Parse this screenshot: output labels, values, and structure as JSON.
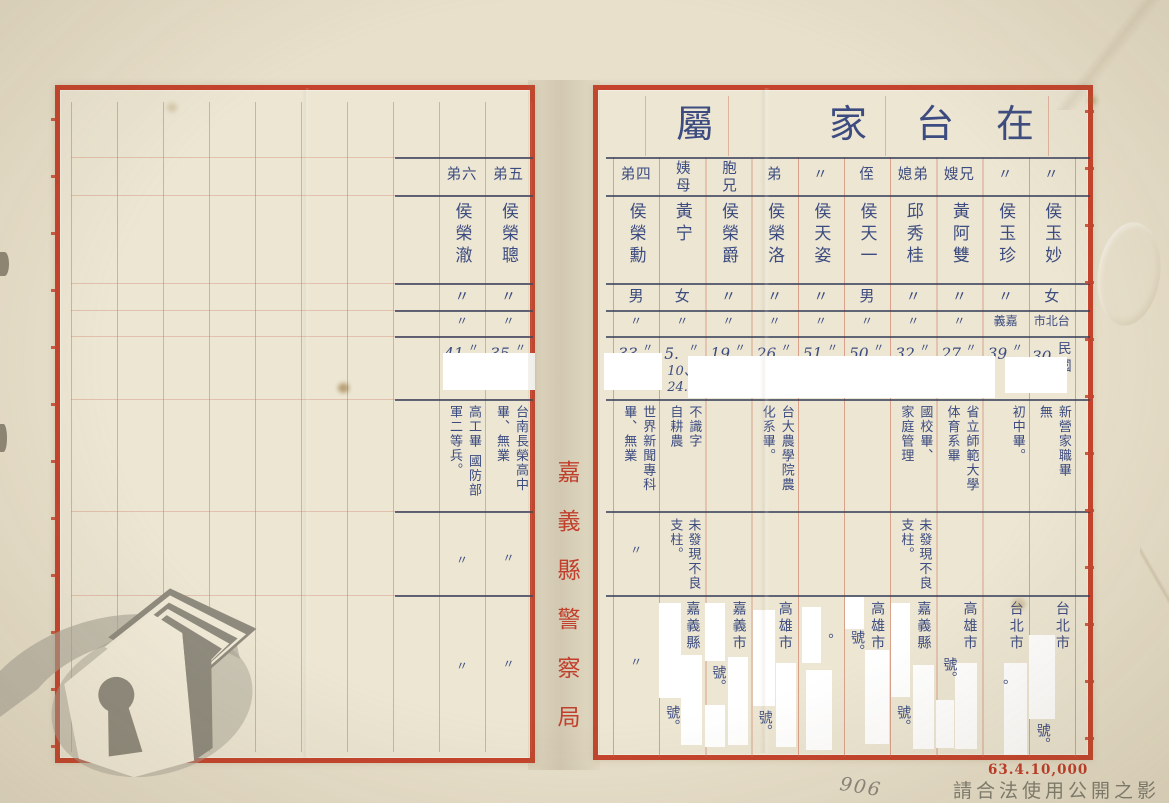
{
  "colors": {
    "paper": "#ece6d3",
    "border_red": "#c5432c",
    "ruling_red": "#ca684e",
    "ink_blue": "#3d4c80",
    "dark_row_line": "#38405c",
    "print_red": "#bf3a26",
    "watermark_gray": "#6c6c60"
  },
  "rp": {
    "header": [
      "屬",
      "家",
      "台",
      "在"
    ],
    "cols": [
      {
        "rel": "弟四",
        "name": "侯榮勳",
        "gender": "男",
        "birthplace": "〃",
        "dit": "〃",
        "num": "33.",
        "extra": "",
        "era": "",
        "edu": "世界新聞專科\n畢、無業",
        "note": "〃",
        "city": "〃",
        "no": ""
      },
      {
        "rel": "姨母",
        "name": "黃宁",
        "gender": "女",
        "birthplace": "〃",
        "dit": "〃",
        "num": "5.",
        "extra": "10、\n24.",
        "era": "",
        "edu": "不識字\n自耕農",
        "note": "未發現不良\n支柱。",
        "city": "嘉義縣",
        "no": "號。"
      },
      {
        "rel": "胞兄",
        "name": "侯榮爵",
        "gender": "〃",
        "birthplace": "〃",
        "dit": "〃",
        "num": "19.",
        "extra": "",
        "era": "",
        "edu": "",
        "note": "",
        "city": "嘉義市",
        "no": "號。"
      },
      {
        "rel": "弟",
        "name": "侯榮洛",
        "gender": "〃",
        "birthplace": "〃",
        "dit": "〃",
        "num": "26.",
        "extra": "",
        "era": "",
        "edu": "台大農學院農\n化系畢。",
        "note": "",
        "city": "高雄市",
        "no": "號。"
      },
      {
        "rel": "〃",
        "name": "侯天姿",
        "gender": "〃",
        "birthplace": "〃",
        "dit": "〃",
        "num": "51.",
        "extra": "",
        "era": "",
        "edu": "",
        "note": "",
        "city": "",
        "no": "。"
      },
      {
        "rel": "侄",
        "name": "侯天一",
        "gender": "男",
        "birthplace": "〃",
        "dit": "〃",
        "num": "50.",
        "extra": "",
        "era": "",
        "edu": "",
        "note": "",
        "city": "高雄市",
        "no": "號。"
      },
      {
        "rel": "媳弟",
        "name": "邱秀桂",
        "gender": "〃",
        "birthplace": "〃",
        "dit": "〃",
        "num": "32.",
        "extra": "",
        "era": "",
        "edu": "國校畢、\n家庭管理",
        "note": "未發現不良\n支柱。",
        "city": "嘉義縣",
        "no": "號。"
      },
      {
        "rel": "嫂兄",
        "name": "黃阿雙",
        "gender": "〃",
        "birthplace": "〃",
        "dit": "〃",
        "num": "27.",
        "extra": "",
        "era": "",
        "edu": "省立師範大學\n体育系畢",
        "note": "",
        "city": "高雄市",
        "no": "號。"
      },
      {
        "rel": "〃",
        "name": "侯玉珍",
        "gender": "〃",
        "birthplace": "義嘉",
        "dit": "〃",
        "num": "39.",
        "extra": "",
        "era": "",
        "edu": "初中畢。",
        "note": "",
        "city": "台北市",
        "no": "。"
      },
      {
        "rel": "〃",
        "name": "侯玉妙",
        "gender": "女",
        "birthplace": "市北台",
        "dit": "",
        "num": "30.",
        "extra": "",
        "era": "民國",
        "edu": "新營家職畢\n無",
        "note": "",
        "city": "台北市",
        "no": "號。"
      }
    ]
  },
  "lp": {
    "cols": [
      {
        "rel": "弟六",
        "name": "侯榮澈",
        "gender": "〃",
        "birthplace": "〃",
        "dit": "〃",
        "num": "41",
        "edu": "高工畢 國防部\n軍二等兵。",
        "note": "〃",
        "city": "〃"
      },
      {
        "rel": "弟五",
        "name": "侯榮聰",
        "gender": "〃",
        "birthplace": "〃",
        "dit": "〃",
        "num": "35.",
        "edu": "台南長榮高中\n畢、無業",
        "note": "〃",
        "city": "〃"
      }
    ]
  },
  "gutter": {
    "agency": "嘉義縣警察局"
  },
  "footer": {
    "print_code": "63.4.10,000",
    "watermark_text": "請合法使用公開之影像",
    "pencil_mark": "906"
  }
}
